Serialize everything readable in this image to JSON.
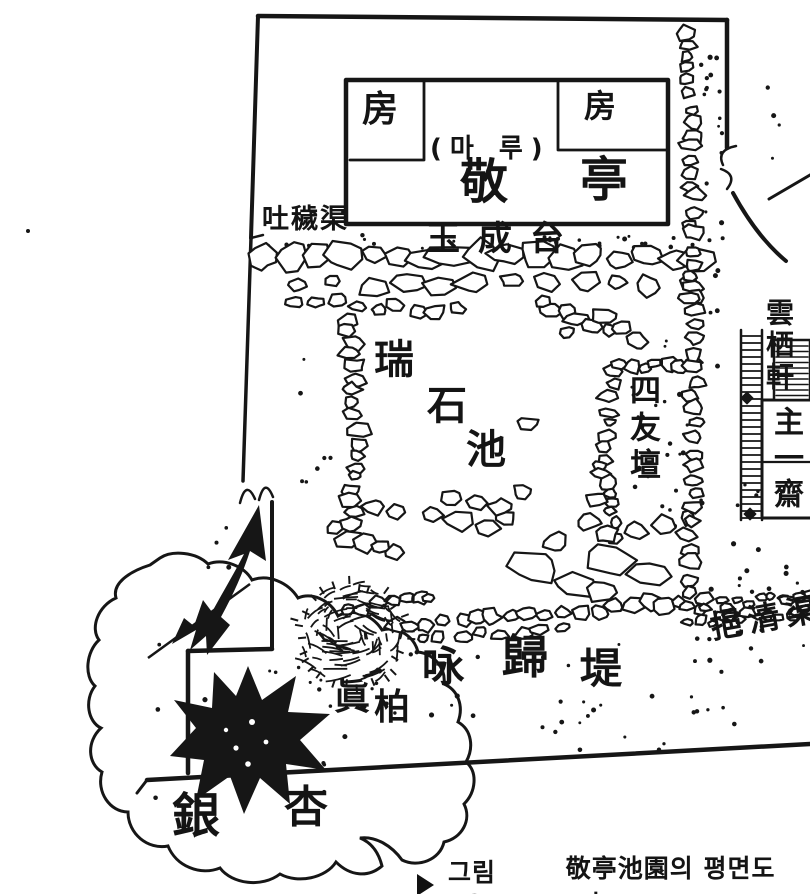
{
  "plan": {
    "outlet_channel": "吐穢渠",
    "inlet_channel": "挹清渠",
    "room_left": "房",
    "room_right": "房",
    "maru": "(마 루)",
    "pavilion_char_1": "敬",
    "pavilion_char_2": "亭",
    "terrace": "玉成台",
    "pond_char_1": "瑞",
    "pond_char_2": "石",
    "pond_char_3": "池",
    "sawudan": "四友壇",
    "unseoheon": "雲栖軒",
    "juiljae": "主一齋",
    "embankment_char_1": "咏",
    "embankment_char_2": "歸",
    "embankment_char_3": "堤",
    "juniper_char_1": "眞",
    "juniper_char_2": "柏",
    "ginkgo_char_1": "銀",
    "ginkgo_char_2": "杏"
  },
  "caption": {
    "figure_label": "그림 52",
    "title": "敬亭池園의 평면도(가"
  },
  "colors": {
    "ink": "#161616",
    "paper": "#ffffff"
  }
}
